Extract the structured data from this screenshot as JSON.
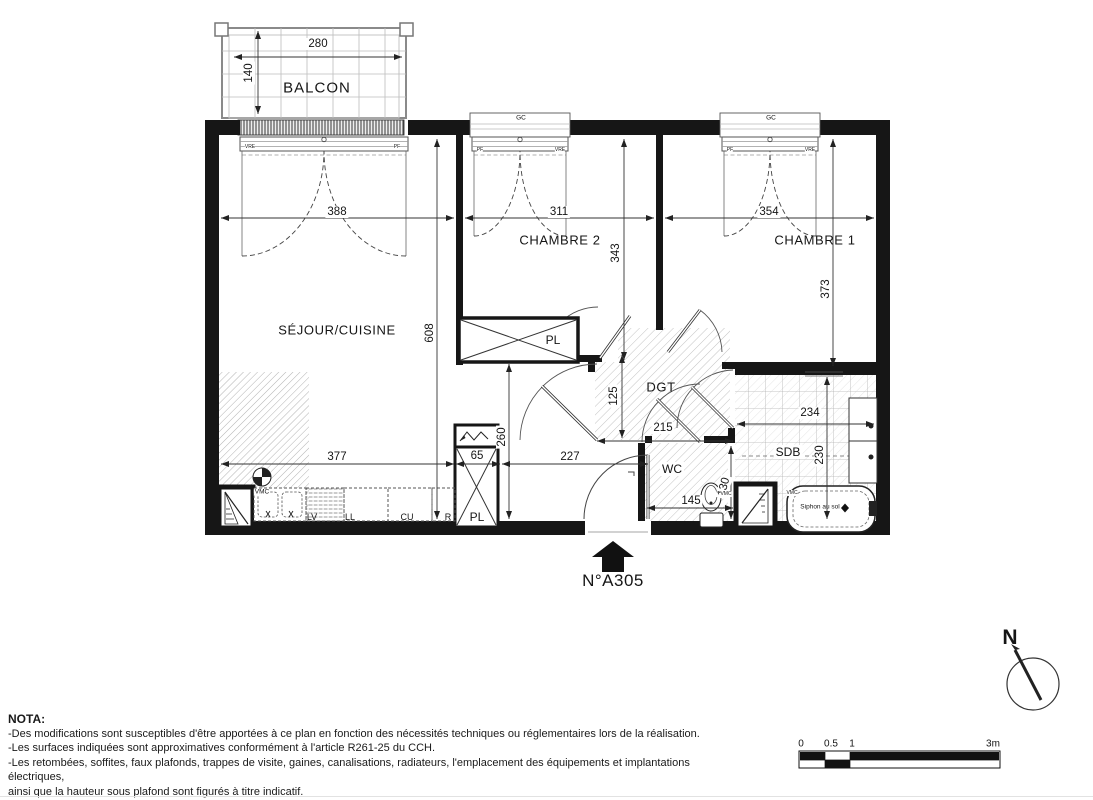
{
  "plan": {
    "unit_label": "N°A305",
    "north_label": "N",
    "rooms": {
      "balcony": "BALCON",
      "living_kitchen": "SÉJOUR/CUISINE",
      "bedroom2": "CHAMBRE 2",
      "bedroom1": "CHAMBRE 1",
      "hallway": "DGT",
      "wc": "WC",
      "bathroom": "SDB"
    },
    "dimensions_cm": {
      "balcony_width": "280",
      "balcony_depth": "140",
      "living_width": "388",
      "bedroom2_width": "311",
      "bedroom1_width": "354",
      "bedroom2_depth": "343",
      "bedroom1_depth": "373",
      "living_depth": "608",
      "kitchen_counter_run": "377",
      "closet_width": "65",
      "counter_depth": "260",
      "entry_run": "227",
      "hallway_depth": "125",
      "hallway_width": "215",
      "bathroom_width": "234",
      "bathroom_depth": "230",
      "wc_width": "145",
      "wc_depth": "130"
    },
    "fixtures": {
      "closet": "PL",
      "dishwasher": "LV",
      "washer": "LL",
      "cooker": "CU",
      "fridge": "R",
      "vent": "VMC",
      "shutter_box": "GC",
      "window_pf": "PF",
      "window_vre": "VRE",
      "floor_drain": "Siphon au sol"
    }
  },
  "scale_bar": {
    "ticks": [
      "0",
      "0.5",
      "1",
      "3m"
    ]
  },
  "nota": {
    "title": "NOTA:",
    "lines": [
      "-Des modifications sont susceptibles d'être apportées à ce plan en fonction des nécessités techniques ou réglementaires lors de la réalisation.",
      "-Les surfaces indiquées sont approximatives conformément à l'article R261-25 du CCH.",
      "-Les retombées, soffites, faux plafonds, trappes de visite, gaines, canalisations, radiateurs, l'emplacement des équipements et implantations électriques,",
      "ainsi que la hauteur sous plafond sont figurés à titre indicatif.",
      "-Les plantations éventuelles ne sont pas contractuelles. L'équipement électroménager et mobilier éventuellement indiqué sur plan n'est pas fourni."
    ]
  }
}
